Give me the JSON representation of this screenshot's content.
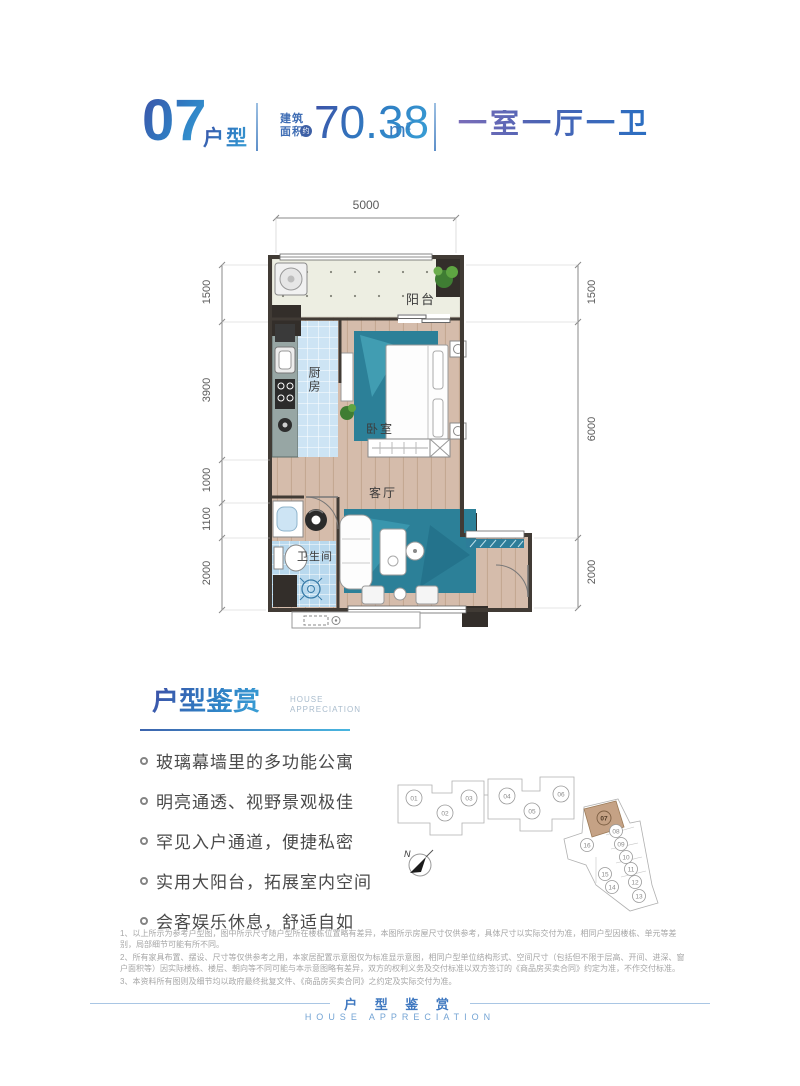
{
  "header": {
    "unit_number": "07",
    "unit_type_label": "户型",
    "area_label_top": "建筑",
    "area_label_bottom": "面积",
    "area_badge": "约",
    "area_value": "70.38",
    "area_unit": "m",
    "area_unit_exp": "2",
    "layout_summary": "一室一厅一卫"
  },
  "floorplan": {
    "dimensions": {
      "top": "5000",
      "left": [
        "1500",
        "3900",
        "1000",
        "1100",
        "2000"
      ],
      "right": [
        "1500",
        "6000",
        "2000"
      ]
    },
    "rooms": {
      "balcony": "阳台",
      "kitchen": "厨房",
      "bedroom": "卧室",
      "living_room": "客厅",
      "bathroom": "卫生间"
    }
  },
  "appreciation": {
    "title": "户型鉴赏",
    "subtitle_line1": "HOUSE",
    "subtitle_line2": "APPRECIATION",
    "bullets": [
      "玻璃幕墙里的多功能公寓",
      "明亮通透、视野景观极佳",
      "罕见入户通道，便捷私密",
      "实用大阳台，拓展室内空间",
      "会客娱乐休息，舒适自如"
    ]
  },
  "keyplan": {
    "units": [
      "01",
      "02",
      "03",
      "04",
      "05",
      "06",
      "07",
      "08",
      "09",
      "10",
      "11",
      "12",
      "13",
      "14",
      "15",
      "16"
    ],
    "highlighted_unit": "07",
    "highlight_color": "#c5a285",
    "north_label": "N"
  },
  "disclaimer": [
    "1、以上所示为参考户型图，图中所示尺寸随户型所在楼栋位置略有差异，本图所示房屋尺寸仅供参考，具体尺寸以实际交付为准，相同户型因楼栋、单元等差别，局部细节可能有所不同。",
    "2、所有家具布置、摆设、尺寸等仅供参考之用，本家居配置示意图仅为标准显示意图，相同户型单位结构形式、空间尺寸（包括但不限于层高、开间、进深、窗户面积等）因实际楼栋、楼层、朝向等不同可能与本示意图略有差异，双方的权利义务及交付标准以双方签订的《商品房买卖合同》约定为准，不作交付标准。",
    "3、本资料所有图则及细节均以政府最终批复文件、《商品房买卖合同》之约定及实际交付为准。"
  ],
  "footer": {
    "title": "户 型 鉴 赏",
    "subtitle": "HOUSE APPRECIATION"
  }
}
